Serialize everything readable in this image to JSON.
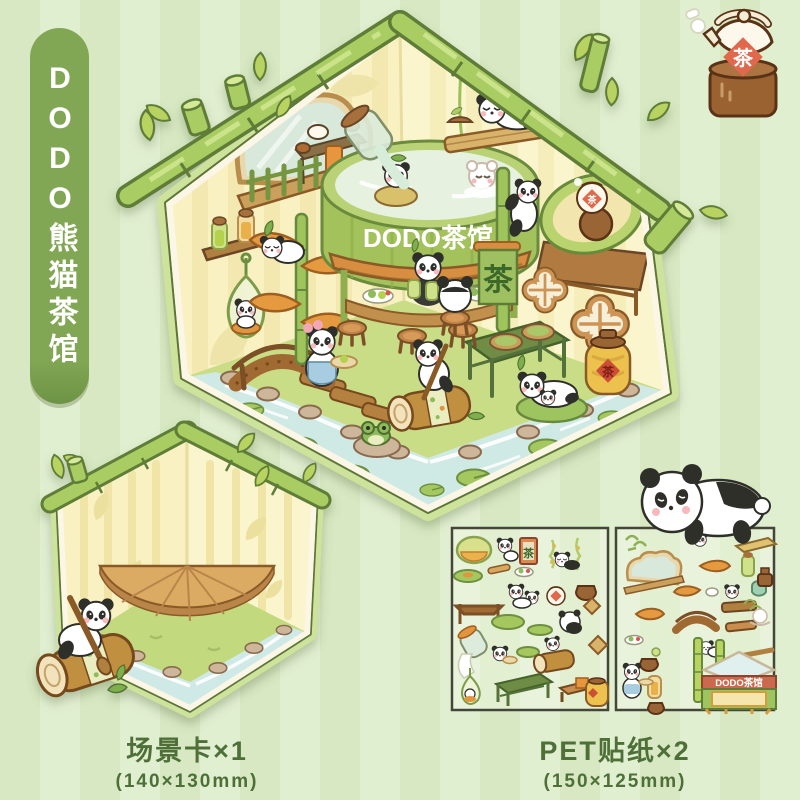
{
  "banner": {
    "title": "DODO熊猫茶馆"
  },
  "teapot_icon": {
    "char": "茶"
  },
  "main_card": {
    "shop_sign": "DODO茶馆",
    "flag_char": "茶",
    "honey_jar_char": "茶",
    "avocado_teapot_char": "茶"
  },
  "scene_card": {
    "label": "场景卡×1",
    "size": "(140×130mm)"
  },
  "sticker_sheets": {
    "label": "PET贴纸×2",
    "size": "(150×125mm)",
    "mini_shop_sign": "DODO茶馆",
    "scroll_char": "茶"
  },
  "palette": {
    "background_stripe_dark": "#d7e8c2",
    "background_stripe_light": "#e1efd1",
    "banner_green": "#82a754",
    "bamboo_green": "#a9cd62",
    "wall_yellow": "#f9f1c2",
    "grass_green": "#c9dd86",
    "water_blue": "#cfe9e4",
    "wood_brown": "#c0903f",
    "accent_orange": "#e69a3f",
    "label_green": "#4e7038",
    "seal_red": "#e0684c"
  }
}
